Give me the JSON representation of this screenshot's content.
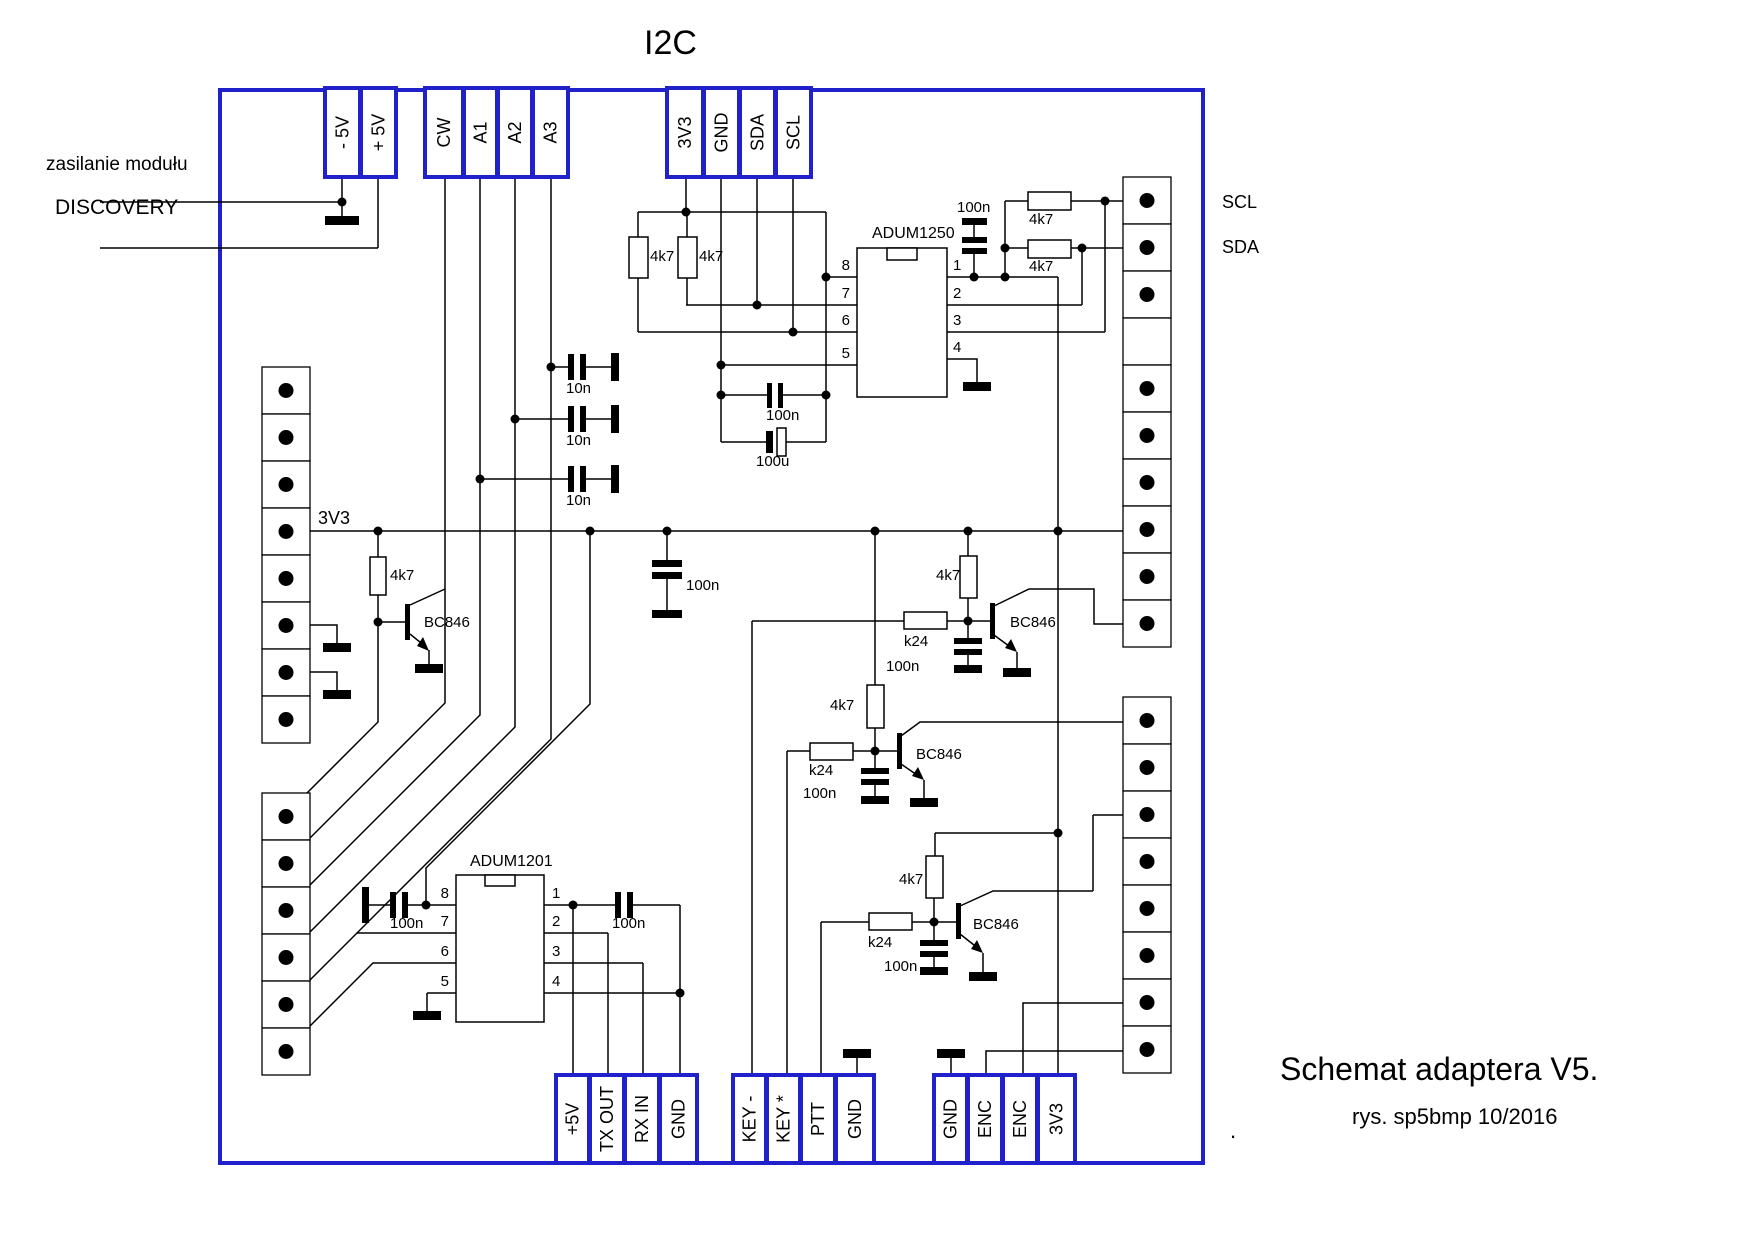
{
  "title": "I2C",
  "footer": {
    "line1": "Schemat adaptera V5.",
    "line2": "rys. sp5bmp  10/2016",
    "dot": "."
  },
  "side_labels": {
    "power": "zasilanie modułu",
    "board": "DISCOVERY",
    "rail": "3V3",
    "scl": "SCL",
    "sda": "SDA"
  },
  "connectors": {
    "top": {
      "power": [
        "- 5V",
        "+ 5V"
      ],
      "signals": [
        "CW",
        "A1",
        "A2",
        "A3"
      ],
      "i2c": [
        "3V3",
        "GND",
        "SDA",
        "SCL"
      ]
    },
    "bottom": {
      "serial": [
        "+5V",
        "TX OUT",
        "RX IN",
        "GND"
      ],
      "keys": [
        "KEY -",
        "KEY *",
        "PTT",
        "GND"
      ],
      "enc": [
        "GND",
        "ENC",
        "ENC",
        "3V3"
      ]
    }
  },
  "ics": [
    {
      "name": "ADUM1250",
      "pins_left": [
        "8",
        "7",
        "6",
        "5"
      ],
      "pins_right": [
        "1",
        "2",
        "3",
        "4"
      ]
    },
    {
      "name": "ADUM1201",
      "pins_left": [
        "8",
        "7",
        "6",
        "5"
      ],
      "pins_right": [
        "1",
        "2",
        "3",
        "4"
      ]
    }
  ],
  "values": {
    "pullup_sda1": "4k7",
    "pullup_scl1": "4k7",
    "pullup_scl2": "4k7",
    "pullup_sda2": "4k7",
    "cap_vdd1": "100n",
    "cap_vdd2": "100n",
    "cap_bulk": "100u",
    "cap_rail": "100n",
    "cap_a3": "10n",
    "cap_a2": "10n",
    "cap_a1": "10n",
    "res_cw": "4k7",
    "q_cw": "BC846",
    "res_key1": "4k7",
    "rser_key1": "k24",
    "cap_key1": "100n",
    "q_key1": "BC846",
    "res_key2": "4k7",
    "rser_key2": "k24",
    "cap_key2": "100n",
    "q_key2": "BC846",
    "res_ptt": "4k7",
    "rser_ptt": "k24",
    "cap_ptt": "100n",
    "q_ptt": "BC846",
    "cap_adum1201_in": "100n",
    "cap_adum1201_out": "100n"
  },
  "colors": {
    "connector_blue": "#2121cc",
    "wire": "#000000",
    "background": "#ffffff"
  }
}
